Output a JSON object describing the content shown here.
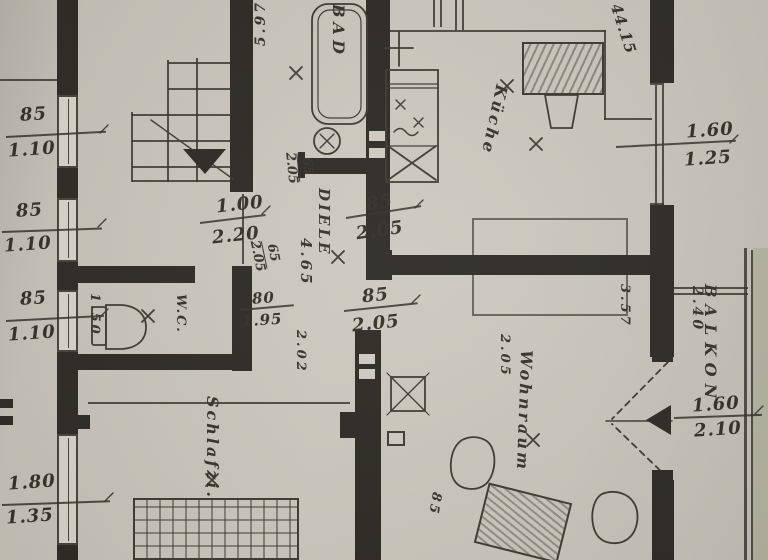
{
  "colors": {
    "paper": "#c9c5bb",
    "ink": "#38342b",
    "wall": "#282520",
    "window_fill": "#d8d4ca",
    "balcony_strip": "#a9ad98"
  },
  "rooms": {
    "bad": {
      "label": "BAD"
    },
    "kueche": {
      "label": "Küche"
    },
    "diele": {
      "label": "DIELE",
      "size": "4.65"
    },
    "wc": {
      "label": "W.C."
    },
    "wohnraum": {
      "label": "Wohnraum"
    },
    "balkon": {
      "label": "BALKON"
    },
    "schlafzimmer": {
      "label": "Schlafzi."
    }
  },
  "dims": {
    "w1": {
      "top": "85",
      "bot": "1.10"
    },
    "w2": {
      "top": "85",
      "bot": "1.10"
    },
    "w3": {
      "top": "85",
      "bot": "1.10"
    },
    "w4": {
      "top": "1.80",
      "bot": "1.35"
    },
    "entry": {
      "top": "1.00",
      "bot": "2.20"
    },
    "d1": {
      "top": "85",
      "bot": "2.05"
    },
    "d2": {
      "top": "85",
      "bot": "2.05"
    },
    "d3": {
      "top": "80",
      "bot": "1.95"
    },
    "rwin": {
      "top": "1.60",
      "bot": "1.25"
    },
    "bdoor": {
      "top": "1.60",
      "bot": "2.10"
    },
    "bad_door": {
      "top": "65",
      "bot": "2.05"
    },
    "wc_door": {
      "top": "65",
      "bot": "2.05"
    },
    "bad_width": "5.97",
    "top_right": "44.15",
    "balcony_depth": "2.40",
    "wohn_width": "3.57",
    "wc_length": "1.50",
    "diele_width": "2.02",
    "pass_height": "2.05",
    "door_85": "85"
  }
}
